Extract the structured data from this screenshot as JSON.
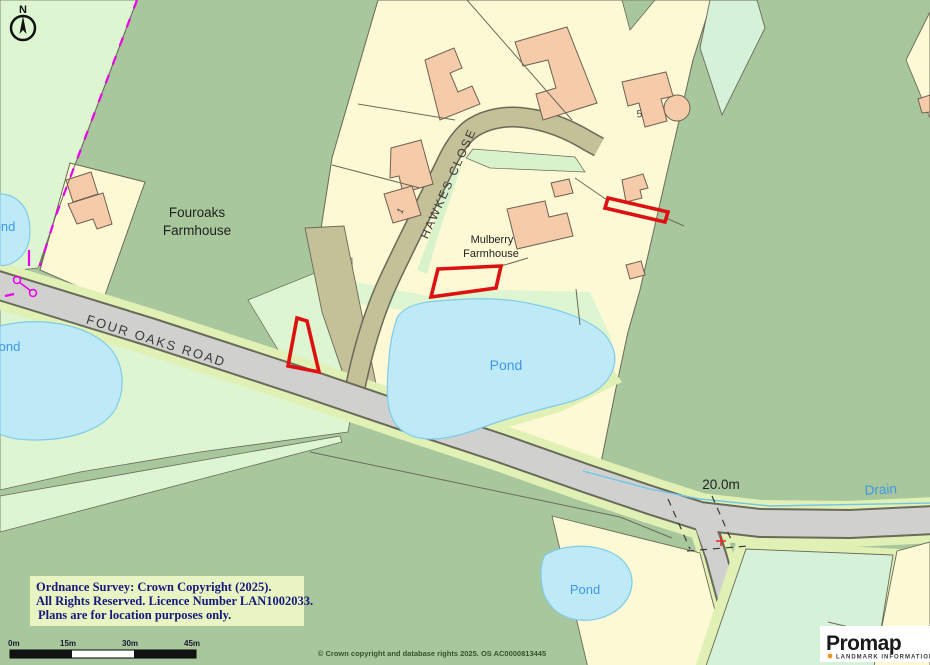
{
  "map": {
    "compass_n": "N",
    "labels": {
      "fouroaks_farmhouse": [
        "Fouroaks",
        "Farmhouse"
      ],
      "mulberry_farmhouse": [
        "Mulberry",
        "Farmhouse"
      ],
      "hawkes_close": "HAWKES CLOSE",
      "four_oaks_road": "FOUR OAKS ROAD",
      "pond_main": "Pond",
      "pond_small_bottom": "Pond",
      "pond_left_upper": "Pond",
      "pond_left_lower": "Pond",
      "drain": "Drain",
      "spot_height": "20.0m",
      "house_number_1": "1",
      "house_number_5": "5"
    },
    "colors": {
      "field_green": "#A9C79C",
      "light_green": "#DDF5D0",
      "parcel_cream": "#FCF9D4",
      "building_peach": "#F6CBAA",
      "road_grey": "#D0D0CE",
      "track_olive": "#C4C098",
      "verge_green": "#E1F0B4",
      "pond_blue": "#BEEAF8",
      "mint_green": "#D5F2D8",
      "plot_outline_red": "#DD1111",
      "boundary_magenta": "#E800E8",
      "label_blue": "#3E97E5"
    }
  },
  "footer": {
    "copyright_line1": "Ordnance Survey: Crown Copyright (2025).",
    "copyright_line2": "All Rights Reserved. Licence Number LAN1002033.",
    "copyright_line3": "Plans are for location purposes only.",
    "os_attribution": "© Crown copyright and database rights 2025. OS AC0000813445",
    "scale_ticks": [
      "0m",
      "15m",
      "30m",
      "45m"
    ]
  },
  "branding": {
    "name": "Promap",
    "tagline": "LANDMARK INFORMATION"
  }
}
